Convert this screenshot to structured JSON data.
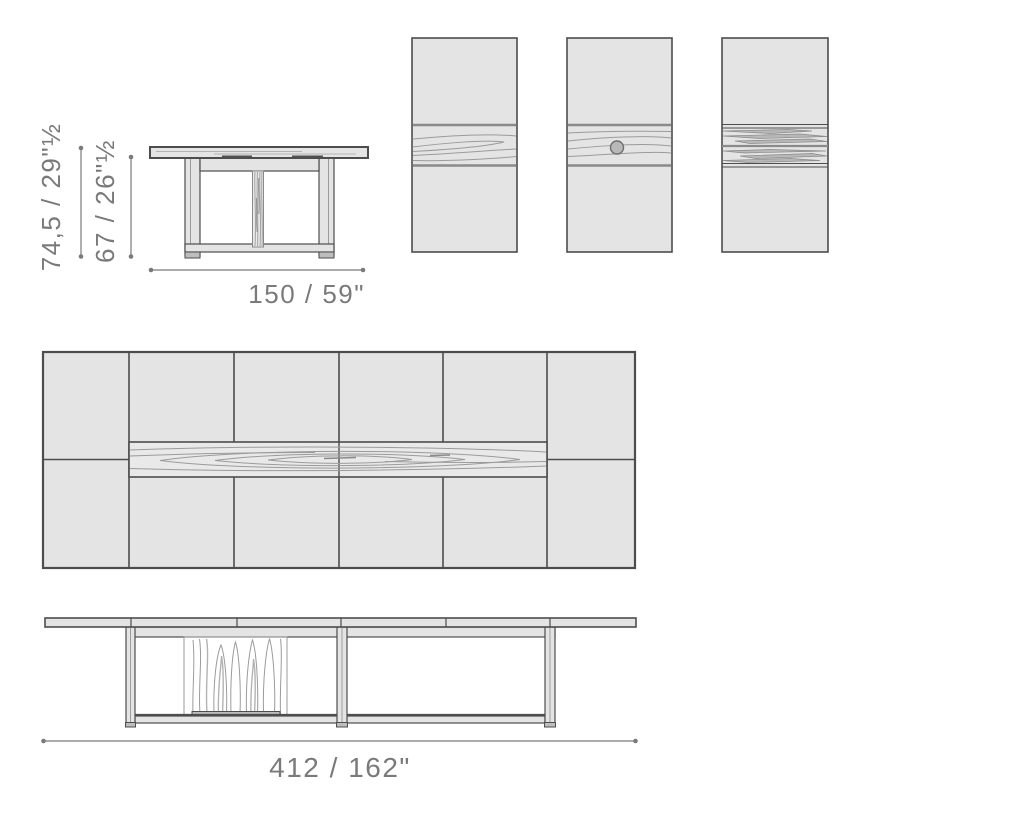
{
  "title": "Extendable dining table technical dimension drawing",
  "palette": {
    "background": "#ffffff",
    "surface_fill": "#e4e4e4",
    "surface_light": "#e9e9e9",
    "outline_strong": "#4d4d4d",
    "outline_soft": "#8a8a8a",
    "grain_line": "#9b9b9b",
    "grain_accent": "#b3b3b3",
    "grain_streak": "#b8b8b8",
    "knot_fill": "#b9b9b9",
    "knot_ring": "#6e6e6e",
    "foot_fill": "#bdbdbd",
    "hardware_dark": "#4f4f4f",
    "dimension": "#7a7a7a"
  },
  "front_view": {
    "height_total_label": "74,5 / 29\"½",
    "height_under_top_label": "67 / 26\"½",
    "width_label": "150 / 59\""
  },
  "side_view": {
    "length_label": "412 / 162\""
  }
}
